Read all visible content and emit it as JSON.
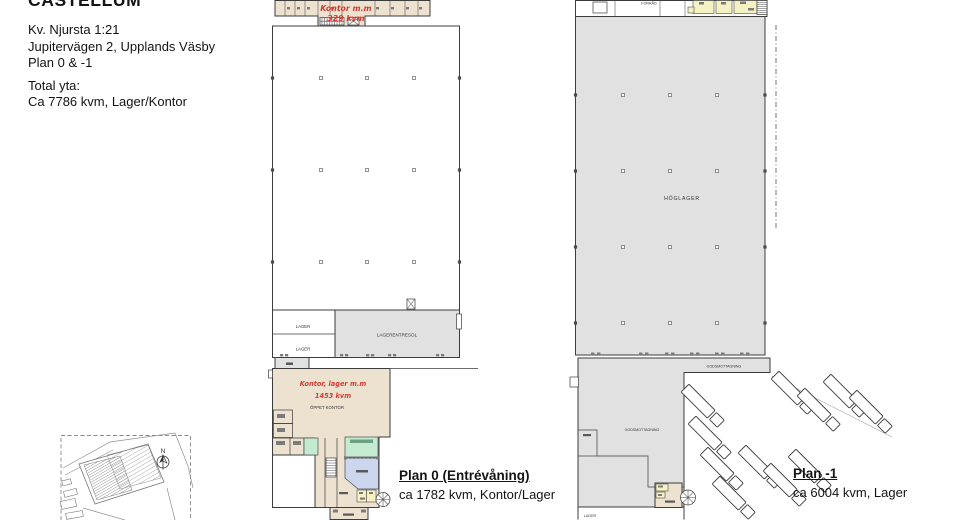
{
  "header": {
    "brand": "CASTELLUM",
    "property": "Kv. Njursta 1:21",
    "address": "Jupitervägen 2, Upplands Väsby",
    "plans": "Plan 0 & -1",
    "total_label": "Total yta:",
    "total_value": "Ca 7786 kvm, Lager/Kontor"
  },
  "plan0": {
    "note_top_line1": "Kontor m.m",
    "note_top_line2": "329 kvm",
    "note_office_line1": "Kontor, lager m.m",
    "note_office_line2": "1453 kvm",
    "label_open_office": "ÖPPET KONTOR",
    "label_entresol": "LAGERENTRESOL",
    "label_lager_a": "LAGER",
    "label_lager_b": "LAGER",
    "caption_title": "Plan 0 (Entrévåning)",
    "caption_detail": "ca 1782 kvm, Kontor/Lager"
  },
  "plan_minus1": {
    "label_forrad": "FÖRRÅD",
    "label_hoglager": "HÖGLAGER",
    "label_gods_dock": "GODSMOTTAGNING",
    "label_gods_hall": "GODSMOTTAGNING",
    "label_lager": "LAGER",
    "caption_title": "Plan -1",
    "caption_detail": "ca 6004 kvm, Lager"
  },
  "site_plan": {
    "north": "N"
  },
  "colors": {
    "beige_room": "#ede2d0",
    "gray_storage": "#e1e1e1",
    "yellow_wet_room": "#f6f1c3",
    "green_room": "#c4ead0",
    "blue_room": "#ccd6ef",
    "red_annotation": "#d93a32",
    "wall": "#3c3c3c"
  }
}
